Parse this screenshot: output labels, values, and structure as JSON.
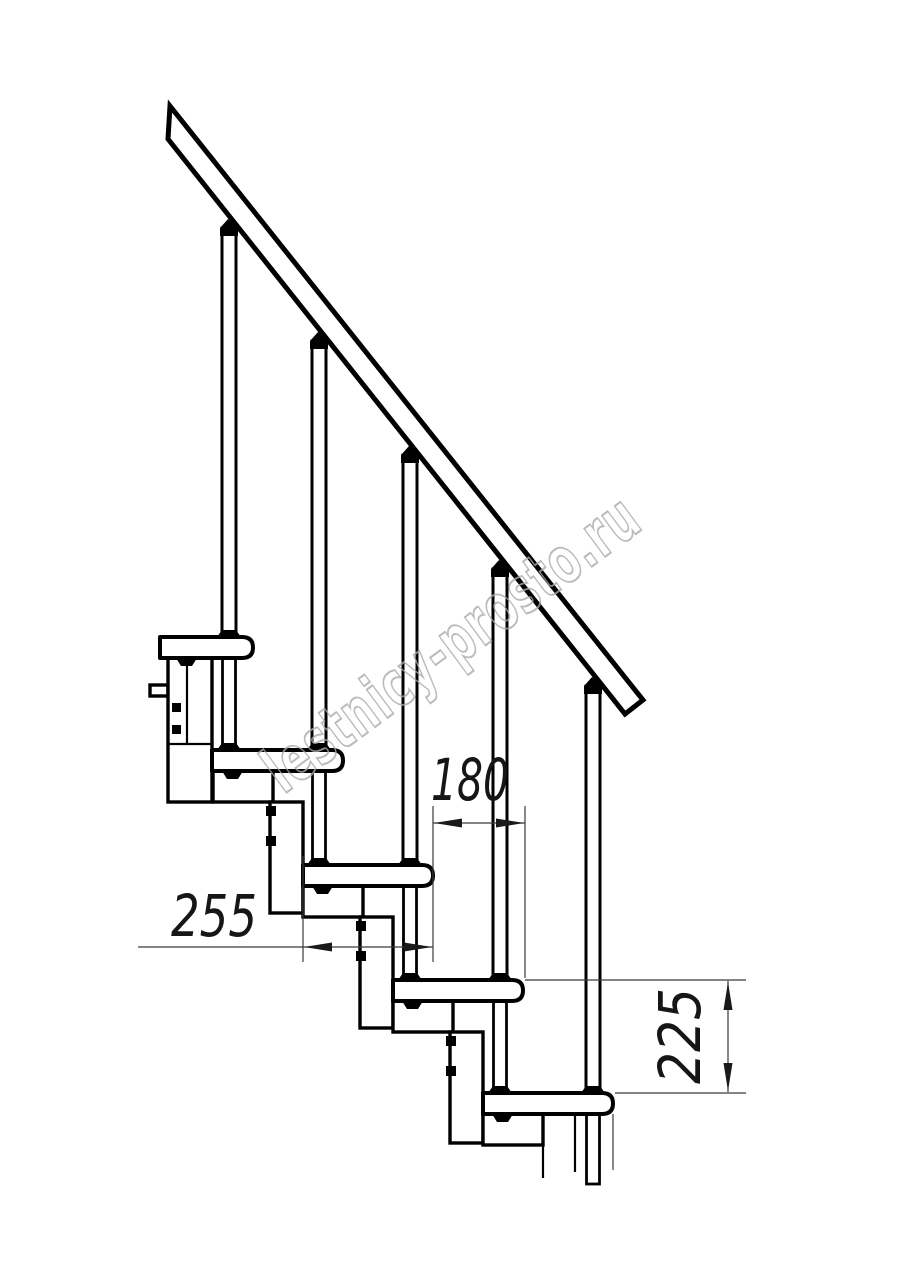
{
  "watermark": {
    "text": "lestnicy-prosto.ru"
  },
  "dimensions": {
    "step_going": {
      "value": "180"
    },
    "module_depth": {
      "value": "255"
    },
    "step_rise": {
      "value": "225"
    }
  }
}
